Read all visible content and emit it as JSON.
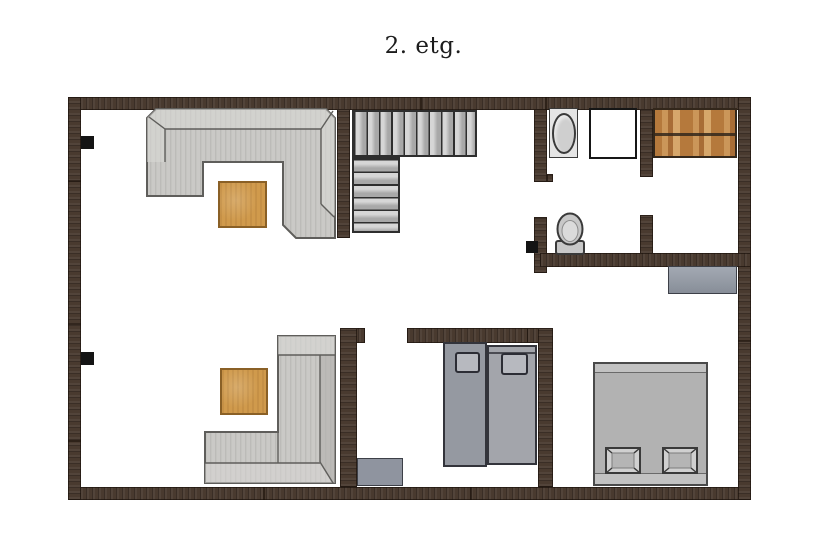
{
  "title": "2. etg.",
  "icons": [
    "u-shaped-sofa",
    "coffee-table",
    "staircase-upper-flight",
    "staircase-lower-flight",
    "bathroom-sink",
    "shower-cabin",
    "wardrobe-cabinet",
    "toilet",
    "hall-dresser",
    "l-shaped-sofa",
    "twin-bed",
    "twin-bed",
    "nightstand",
    "double-bed",
    "bed-pillow",
    "wall-socket-marker"
  ],
  "palette": {
    "background": "#ffffff",
    "title_color": "#1c1c1c",
    "wall": "#493a2f",
    "seam": "#170e08",
    "marker": "#141414",
    "stair_fill": "#a8a8a8",
    "stair_hi": "#d6d6d6",
    "stair_line": "#2e2e2e",
    "sofa_fill": "#cac9c6",
    "sofa_stripe": "#bcbbb8",
    "sofa_light": "#d9d8d5",
    "sofa_dark": "#b2b1ae",
    "sofa_outline": "#5f5e5b",
    "table_fill": "#d09a4c",
    "table_border": "#8a6026",
    "sink_fill": "#e5e5e5",
    "basin_fill": "#cfcfcf",
    "fixture_line": "#3a3a3a",
    "shower_border": "#161616",
    "wood_a": "#b5793c",
    "wood_b": "#cb9659",
    "wood_c": "#a86d36",
    "wood_d": "#d6a76b",
    "wood_border": "#33271b",
    "toilet_fill": "#c8c8c8",
    "dresser_fill": "#939aa5",
    "dresser_border": "#3d4048",
    "bed_left_fill": "#9599a1",
    "bed_right_fill": "#a3a5ab",
    "bed_border": "#33343b",
    "pillow_fill": "#b7b9bf",
    "pillow_border": "#2c2d35",
    "master_fill": "#b2b2b2",
    "master_strip": "#c2c2c2",
    "master_border": "#4a4a4a",
    "mpillow_fill": "#d0d0d0",
    "mpillow_inner": "#b5b5b5"
  }
}
